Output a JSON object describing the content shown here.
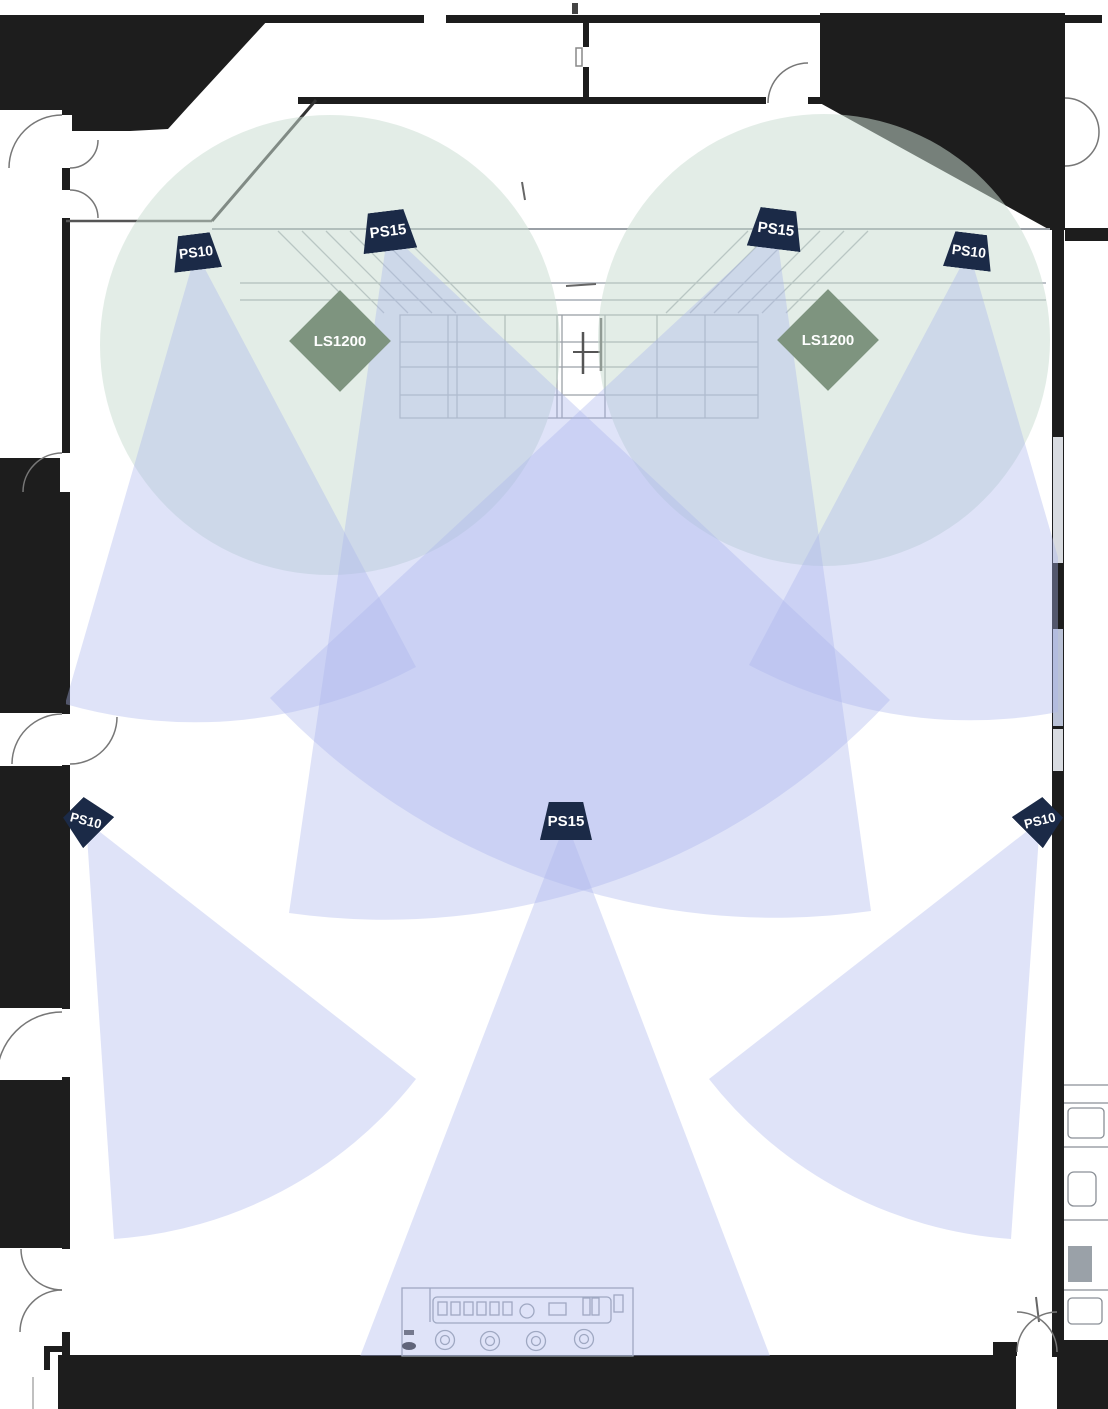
{
  "plan": {
    "speakers": [
      {
        "id": "ps10-top-left",
        "label": "PS10"
      },
      {
        "id": "ps15-top-left",
        "label": "PS15"
      },
      {
        "id": "ps15-top-right",
        "label": "PS15"
      },
      {
        "id": "ps10-top-right",
        "label": "PS10"
      },
      {
        "id": "ps10-mid-left",
        "label": "PS10"
      },
      {
        "id": "ps15-mid-center",
        "label": "PS15"
      },
      {
        "id": "ps10-mid-right",
        "label": "PS10"
      }
    ],
    "subwoofers": [
      {
        "id": "ls1200-left",
        "label": "LS1200"
      },
      {
        "id": "ls1200-right",
        "label": "LS1200"
      }
    ],
    "colors": {
      "speaker_marker": "#1b2a47",
      "subwoofer_marker": "#7e947f",
      "marker_text": "#ffffff",
      "coverage_cone": "#abb5ec",
      "subwoofer_coverage": "#cadcd1",
      "walls": "#1d1d1d"
    }
  }
}
